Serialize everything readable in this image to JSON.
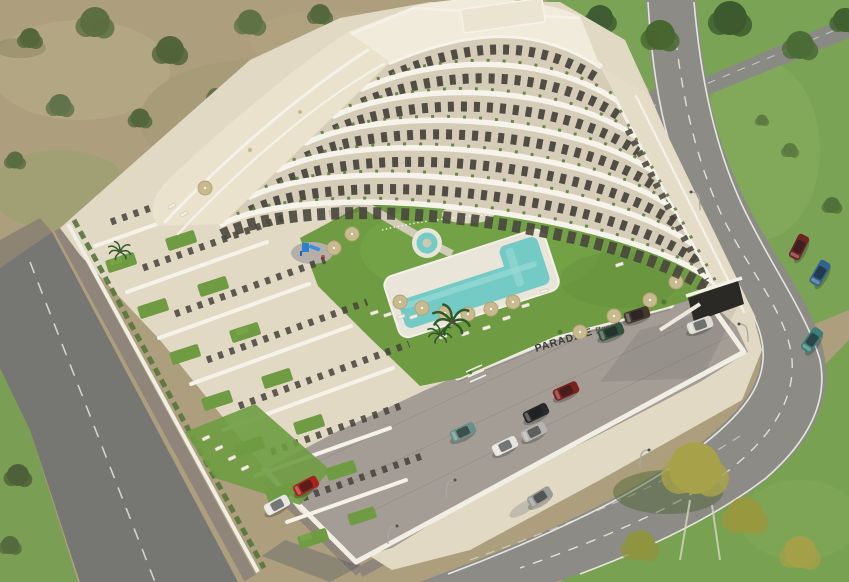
{
  "sign": {
    "primary": "PARADISE",
    "secondary": "Resort"
  },
  "palette": {
    "building_white": "#f6f3ea",
    "wall_beige": "#d6cdb9",
    "terrace_cream": "#e9e1cc",
    "lawn_green": "#6f9c43",
    "field_green": "#7ba355",
    "dry_field_tan": "#ad9f7d",
    "pool_water": "#74cbc6",
    "umbrella_tan": "#c9b98e",
    "road_asphalt": "#8c8b86",
    "road_dark": "#767672",
    "parking_gray": "#a39d96",
    "sign_text": "#3b3b39"
  },
  "cars": [
    {
      "label": "white-hatchback",
      "color": "#e8e6e2"
    },
    {
      "label": "red-compact",
      "color": "#a8231c"
    },
    {
      "label": "teal-suv",
      "color": "#6a9089"
    },
    {
      "label": "black-sedan",
      "color": "#2a2a2c"
    },
    {
      "label": "white-sedan",
      "color": "#e6e4df"
    },
    {
      "label": "silver-sedan",
      "color": "#b6b4b0"
    },
    {
      "label": "dark-red-sedan",
      "color": "#7c221c"
    },
    {
      "label": "brown-suv",
      "color": "#45392f"
    },
    {
      "label": "green-sedan",
      "color": "#33523c"
    },
    {
      "label": "white-van",
      "color": "#dddbd4"
    },
    {
      "label": "maroon-suv",
      "color": "#6e2420"
    },
    {
      "label": "blue-sedan",
      "color": "#33628f"
    },
    {
      "label": "teal-van",
      "color": "#3e7e78"
    },
    {
      "label": "moving-silver-car",
      "color": "#9b9b98"
    }
  ],
  "scene": {
    "type": "aerial-3d-architectural-render",
    "subject": "white terraced apartment complex with pool courtyard, parking lot and perimeter roads"
  }
}
